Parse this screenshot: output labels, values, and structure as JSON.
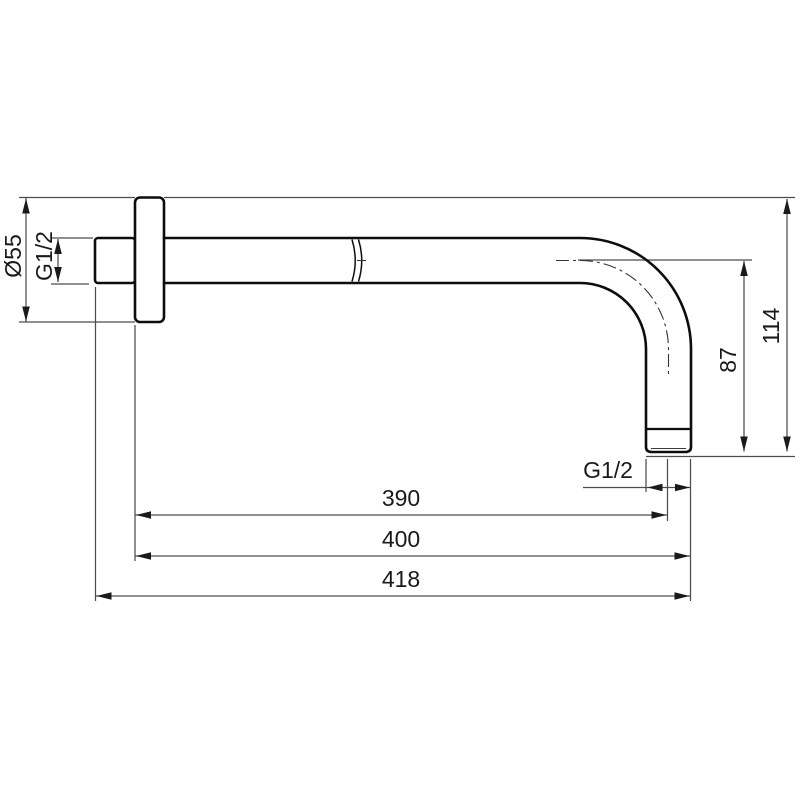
{
  "drawing": {
    "kind": "technical-dimension-drawing",
    "colors": {
      "background": "#ffffff",
      "part_outline": "#0d0d0d",
      "dimension_lines": "#4d4d4d",
      "text": "#1a1a1a"
    },
    "labels": {
      "flange_diameter": "Ø55",
      "wall_thread": "G1/2",
      "drop_to_centerline": "87",
      "drop_overall": "114",
      "outlet_thread": "G1/2",
      "length_to_outlet_centerline": "390",
      "length_wall_to_outlet_edge": "400",
      "length_overall": "418"
    }
  }
}
